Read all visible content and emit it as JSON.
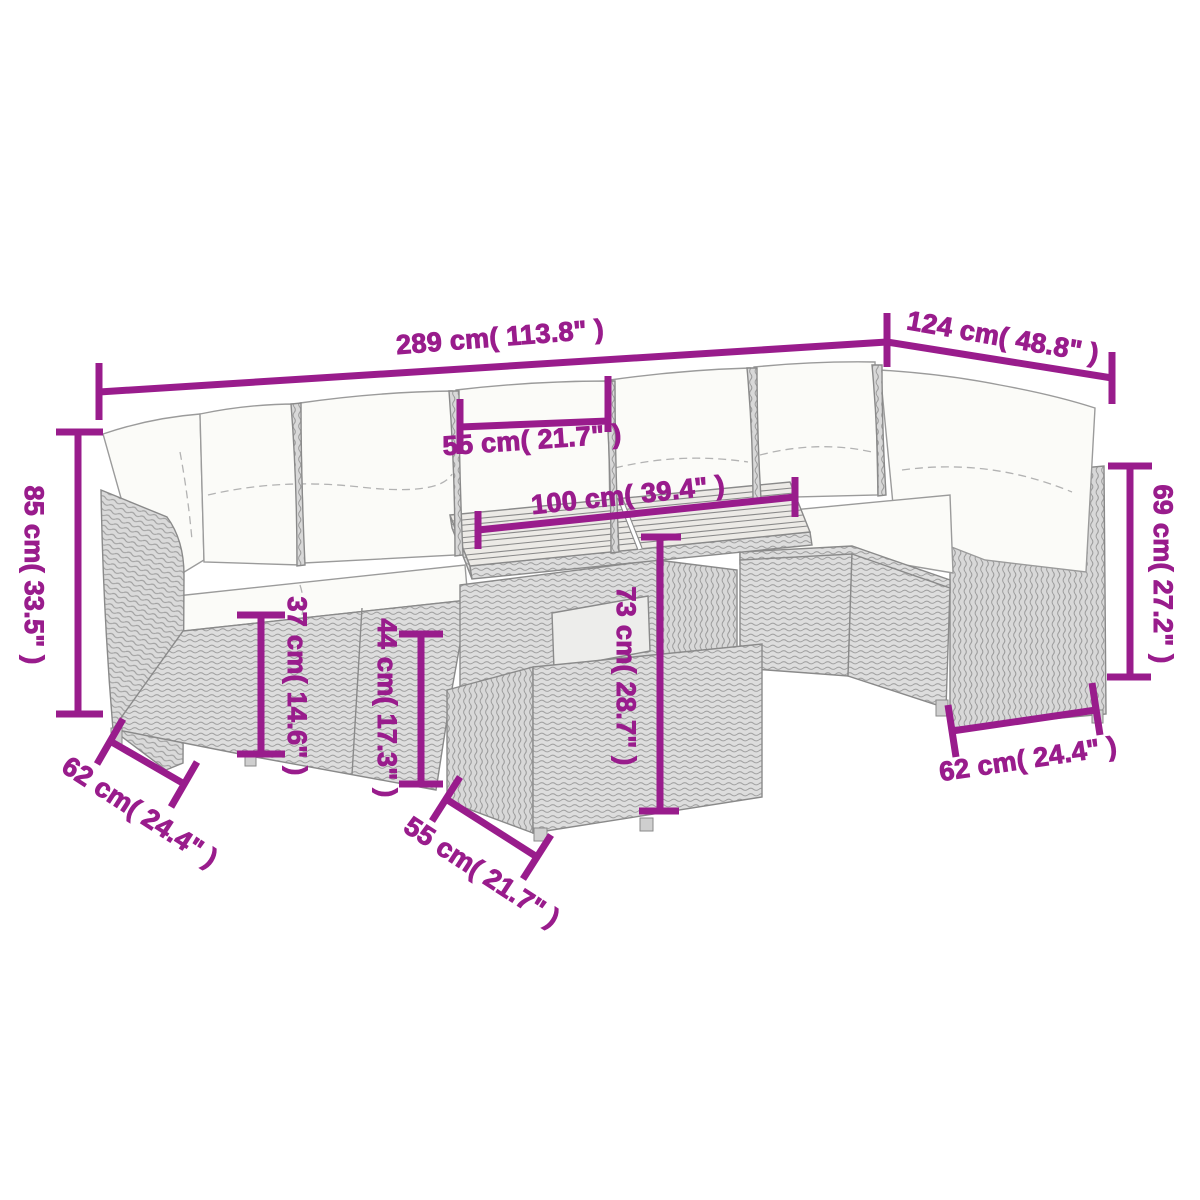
{
  "diagram": {
    "kind": "product-dimension-diagram",
    "subject": "garden rattan lounge set with table",
    "background": "#ffffff",
    "accent_color": "#991c8c",
    "furniture_fill": "#dddddd",
    "furniture_line": "#8a8a8a",
    "cushion_fill": "#fbfbf8"
  },
  "dimensions": {
    "total_width": "289 cm( 113.8\" )",
    "right_depth": "124 cm( 48.8\" )",
    "table_top_depth": "55 cm( 21.7\" )",
    "table_width": "100 cm( 39.4\" )",
    "back_height_left": "85 cm( 33.5\" )",
    "back_height_right": "69 cm( 27.2\" )",
    "seat_frame_height": "37 cm( 14.6\" )",
    "seat_height": "44 cm( 17.3\" )",
    "table_height": "73 cm( 28.7\" )",
    "module_depth_left": "62 cm( 24.4\" )",
    "table_base_depth": "55 cm( 21.7\" )",
    "module_depth_right": "62 cm( 24.4\" )"
  }
}
